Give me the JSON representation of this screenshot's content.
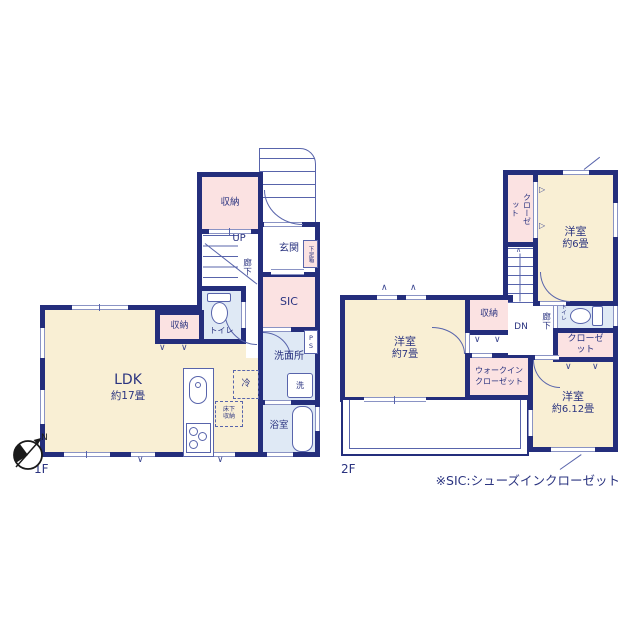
{
  "floor1": {
    "label": "1F",
    "ldk_name": "LDK",
    "ldk_size": "約17畳",
    "storage_top": "収納",
    "storage_mid": "収納",
    "entrance": "玄関",
    "shoe_box": "下足箱",
    "sic": "SIC",
    "toilet": "トイレ",
    "corridor": "廊下",
    "up": "UP",
    "washroom": "洗面所",
    "ps": "PS",
    "washer": "洗",
    "bathroom": "浴室",
    "fridge": "冷",
    "underfloor_storage": "床下収納"
  },
  "floor2": {
    "label": "2F",
    "room6_name": "洋室",
    "room6_size": "約6畳",
    "room7_name": "洋室",
    "room7_size": "約7畳",
    "room612_name": "洋室",
    "room612_size": "約6.12畳",
    "closet_upper": "クローゼット",
    "closet_right": "クローゼット",
    "walk_in_closet": "ウォークインクローゼット",
    "storage": "収納",
    "toilet": "トイレ",
    "corridor": "廊下",
    "dn": "DN"
  },
  "note": "※SIC:シューズインクローゼット",
  "compass": {
    "north": "N"
  },
  "marks": {
    "hanger_v": "∨",
    "vent": "∧",
    "hanger_right": "▷"
  },
  "colors": {
    "wall": "#242e7c",
    "line": "#5864ab",
    "room": "#f9efd4",
    "closet": "#fbe2e2",
    "wet": "#dfe9f5",
    "text": "#2b3480"
  }
}
